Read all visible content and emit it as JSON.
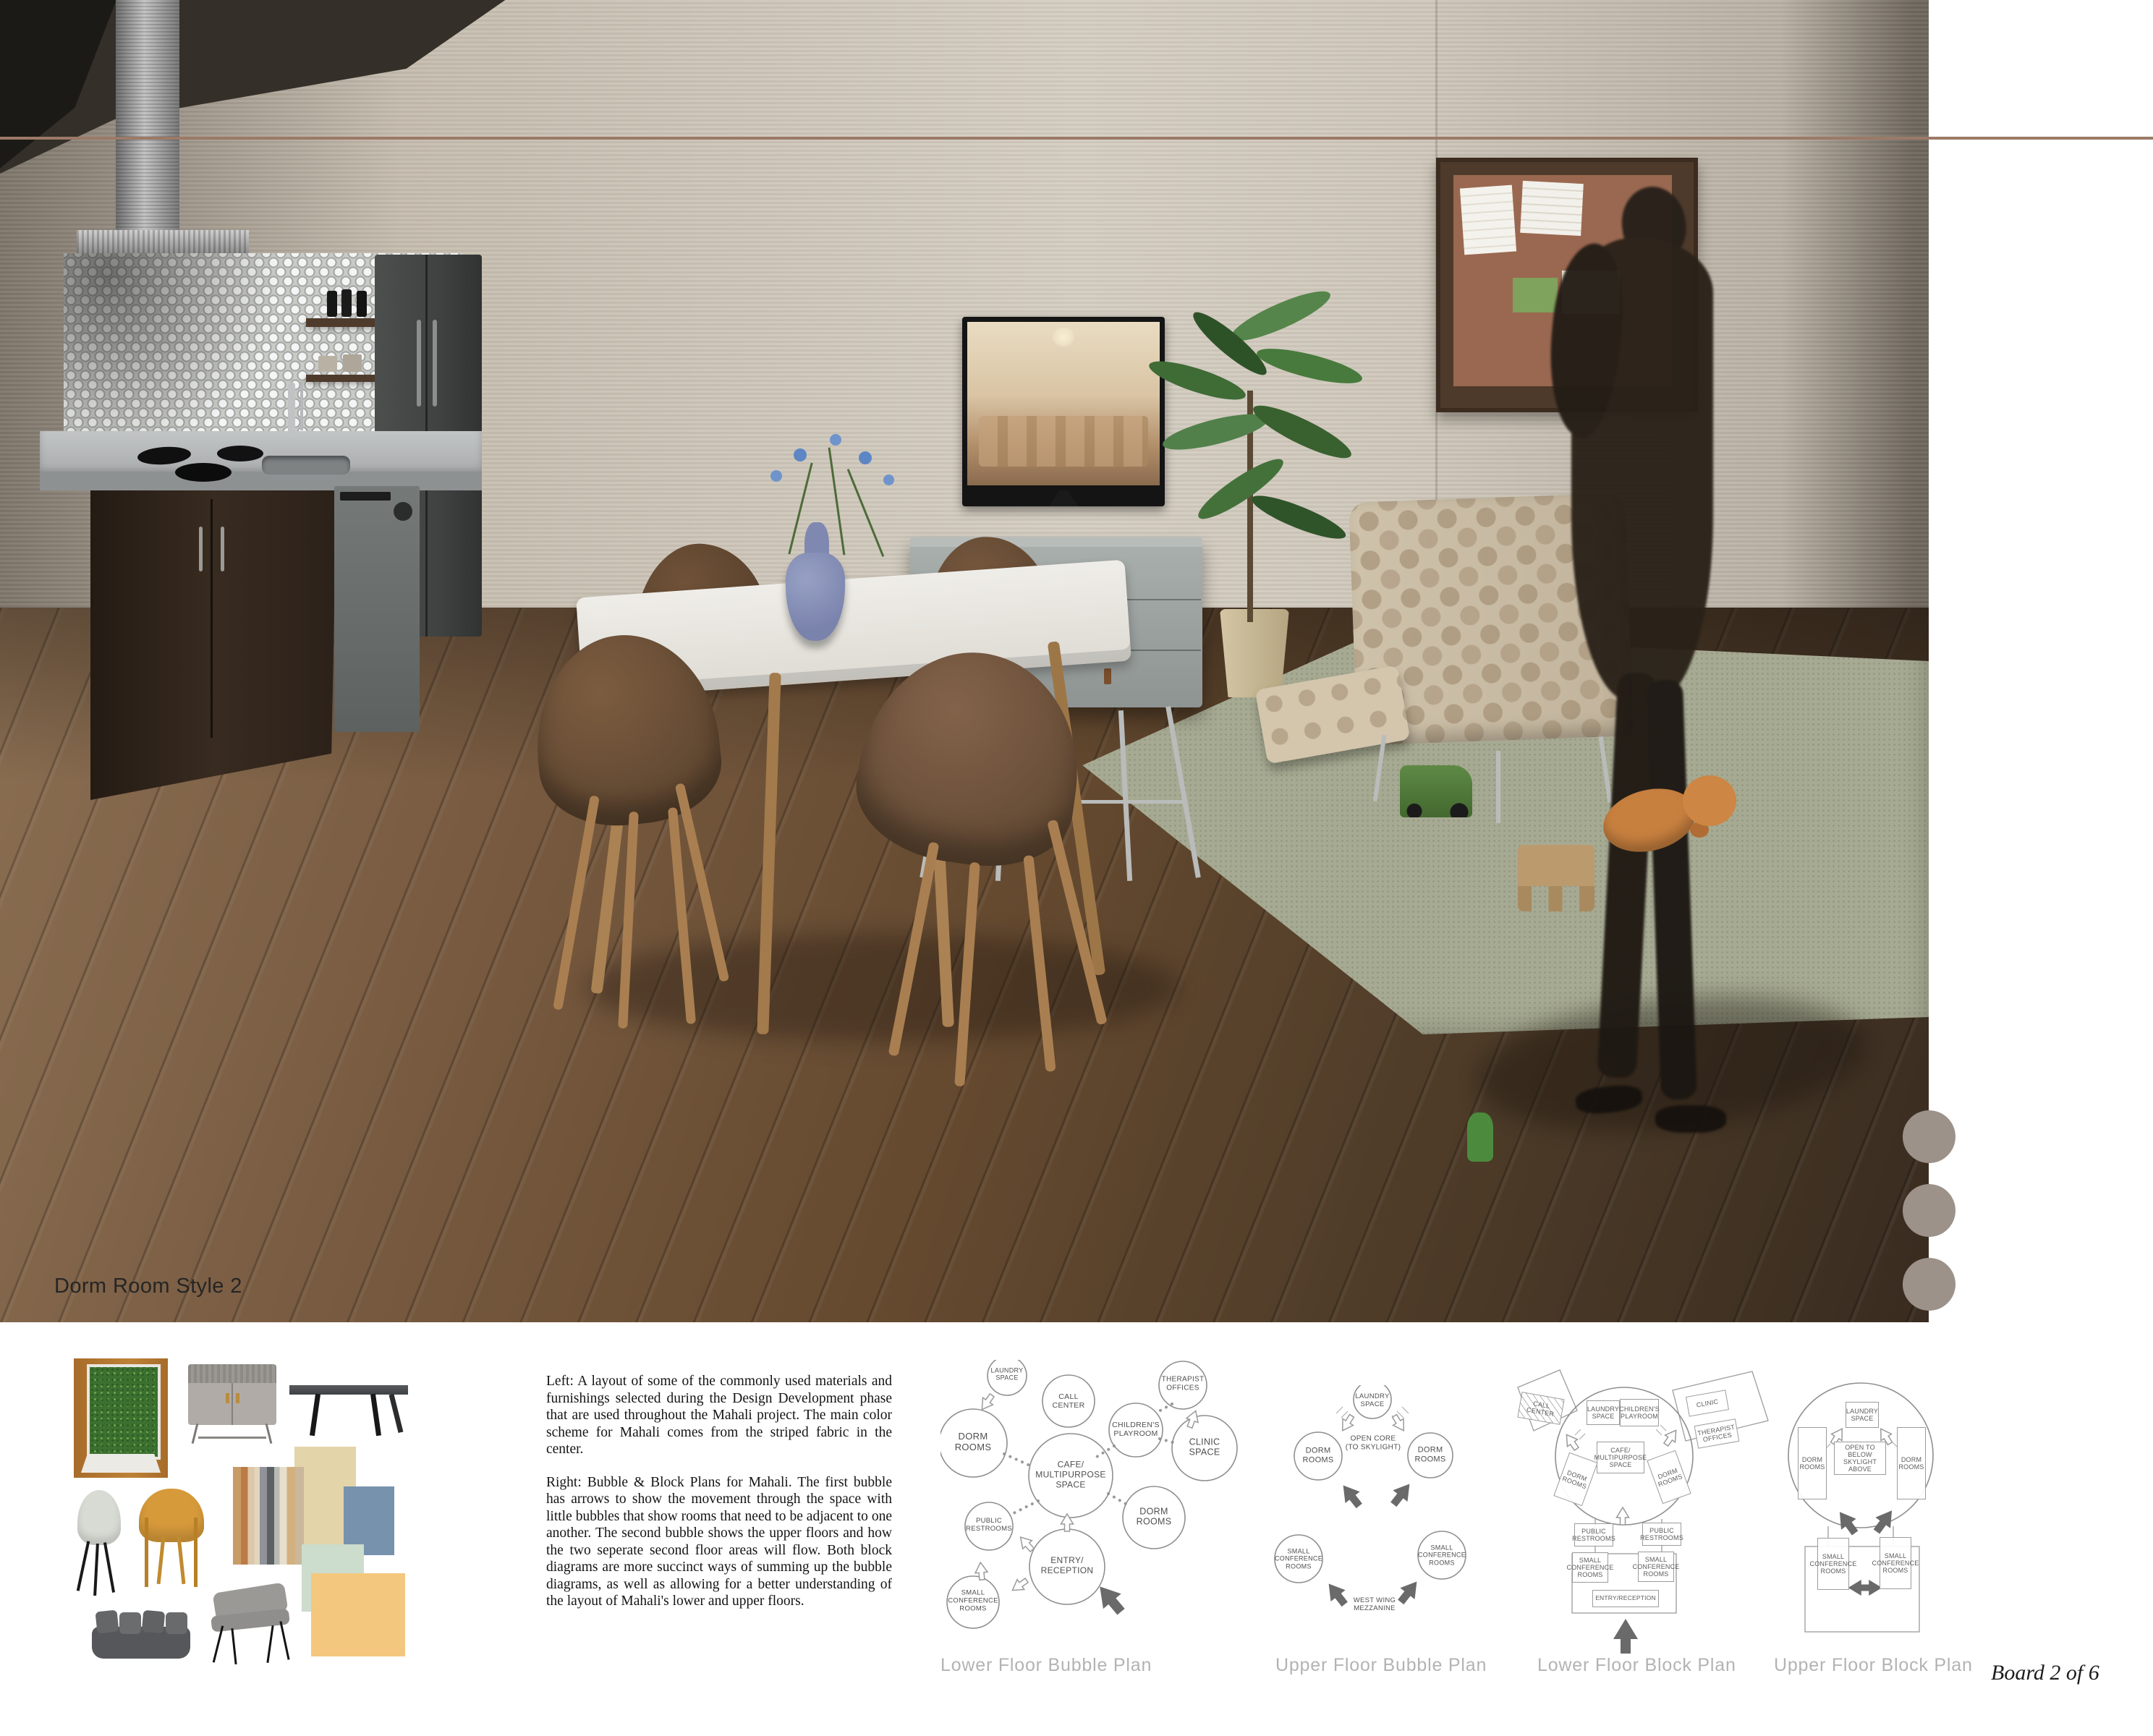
{
  "board": {
    "render_label": "Dorm Room Style 2",
    "board_number": "Board 2 of  6",
    "accent_line_color": "#9b7a67",
    "side_dot_color": "#9c9289",
    "caption_color": "#b3b3b3"
  },
  "description": {
    "left_paragraph": "Left: A layout of some of the commonly used materials and furnishings selected during the Design Development phase that are used throughout the Mahali project. The main color scheme for Mahali comes from the striped fabric in the center.",
    "right_paragraph": "Right: Bubble & Block Plans for Mahali. The first bubble has arrows to show the movement through the space with little bubbles that show rooms that need to be adjacent to one another. The second bubble shows the upper floors and how the two seperate second floor areas will flow. Both block diagrams are more succinct ways of summing up the bubble diagrams, as well as allowing for a better understanding of the layout of Mahali's lower and upper floors."
  },
  "diagrams": {
    "lower_bubble": {
      "caption": "Lower Floor Bubble Plan",
      "labels": {
        "laundry": "LAUNDRY\nSPACE",
        "call_center": "CALL\nCENTER",
        "therapist": "THERAPIST\nOFFICES",
        "dorm_left": "DORM\nROOMS",
        "children": "CHILDREN'S\nPLAYROOM",
        "clinic": "CLINIC\nSPACE",
        "cafe": "CAFE/\nMULTIPURPOSE\nSPACE",
        "dorm_right": "DORM\nROOMS",
        "restrooms": "PUBLIC\nRESTROOMS",
        "entry": "ENTRY/\nRECEPTION",
        "small_conf": "SMALL\nCONFERENCE\nROOMS"
      }
    },
    "upper_bubble": {
      "caption": "Upper Floor Bubble Plan",
      "labels": {
        "laundry": "LAUNDRY\nSPACE",
        "open_core": "OPEN CORE\n(TO SKYLIGHT)",
        "dorm_left": "DORM\nROOMS",
        "dorm_right": "DORM\nROOMS",
        "conf_left": "SMALL\nCONFERENCE\nROOMS",
        "conf_right": "SMALL\nCONFERENCE\nROOMS",
        "mezzanine": "WEST WING\nMEZZANINE"
      }
    },
    "lower_block": {
      "caption": "Lower Floor Block Plan",
      "labels": {
        "call_center": "CALL\nCENTER",
        "laundry": "LAUNDRY\nSPACE",
        "children": "CHILDREN'S\nPLAYROOM",
        "clinic": "CLINIC",
        "therapist": "THERAPIST\nOFFICES",
        "cafe": "CAFE/\nMULTIPURPOSE\nSPACE",
        "dorm_left": "DORM\nROOMS",
        "dorm_right": "DORM\nROOMS",
        "restrooms_left": "PUBLIC\nRESTROOMS",
        "restrooms_right": "PUBLIC\nRESTROOMS",
        "conf_left": "SMALL\nCONFERENCE\nROOMS",
        "conf_right": "SMALL\nCONFERENCE\nROOMS",
        "entry": "ENTRY/RECEPTION"
      }
    },
    "upper_block": {
      "caption": "Upper Floor Block Plan",
      "labels": {
        "laundry": "LAUNDRY\nSPACE",
        "open_below": "OPEN TO BELOW\nSKYLIGHT\nABOVE",
        "dorm_left": "DORM\nROOMS",
        "dorm_right": "DORM\nROOMS",
        "conf_left": "SMALL\nCONFERENCE\nROOMS",
        "conf_right": "SMALL\nCONFERENCE\nROOMS"
      }
    }
  },
  "materials": {
    "swatch_colors": {
      "striped_fabric": [
        "#c89c66",
        "#bd7a45",
        "#dcc8a8",
        "#e2d5bb",
        "#90939a",
        "#5e6163",
        "#b8bab4",
        "#e7dfcc",
        "#d3b07f"
      ],
      "cream": "#e4d4a9",
      "blue": "#7792ad",
      "mint": "#ccdccd",
      "orange": "#f3c87e",
      "mustard_chair": "#d79a3b",
      "gray_chair": "#d8dad4",
      "dark_sofa": "#55575a"
    }
  }
}
